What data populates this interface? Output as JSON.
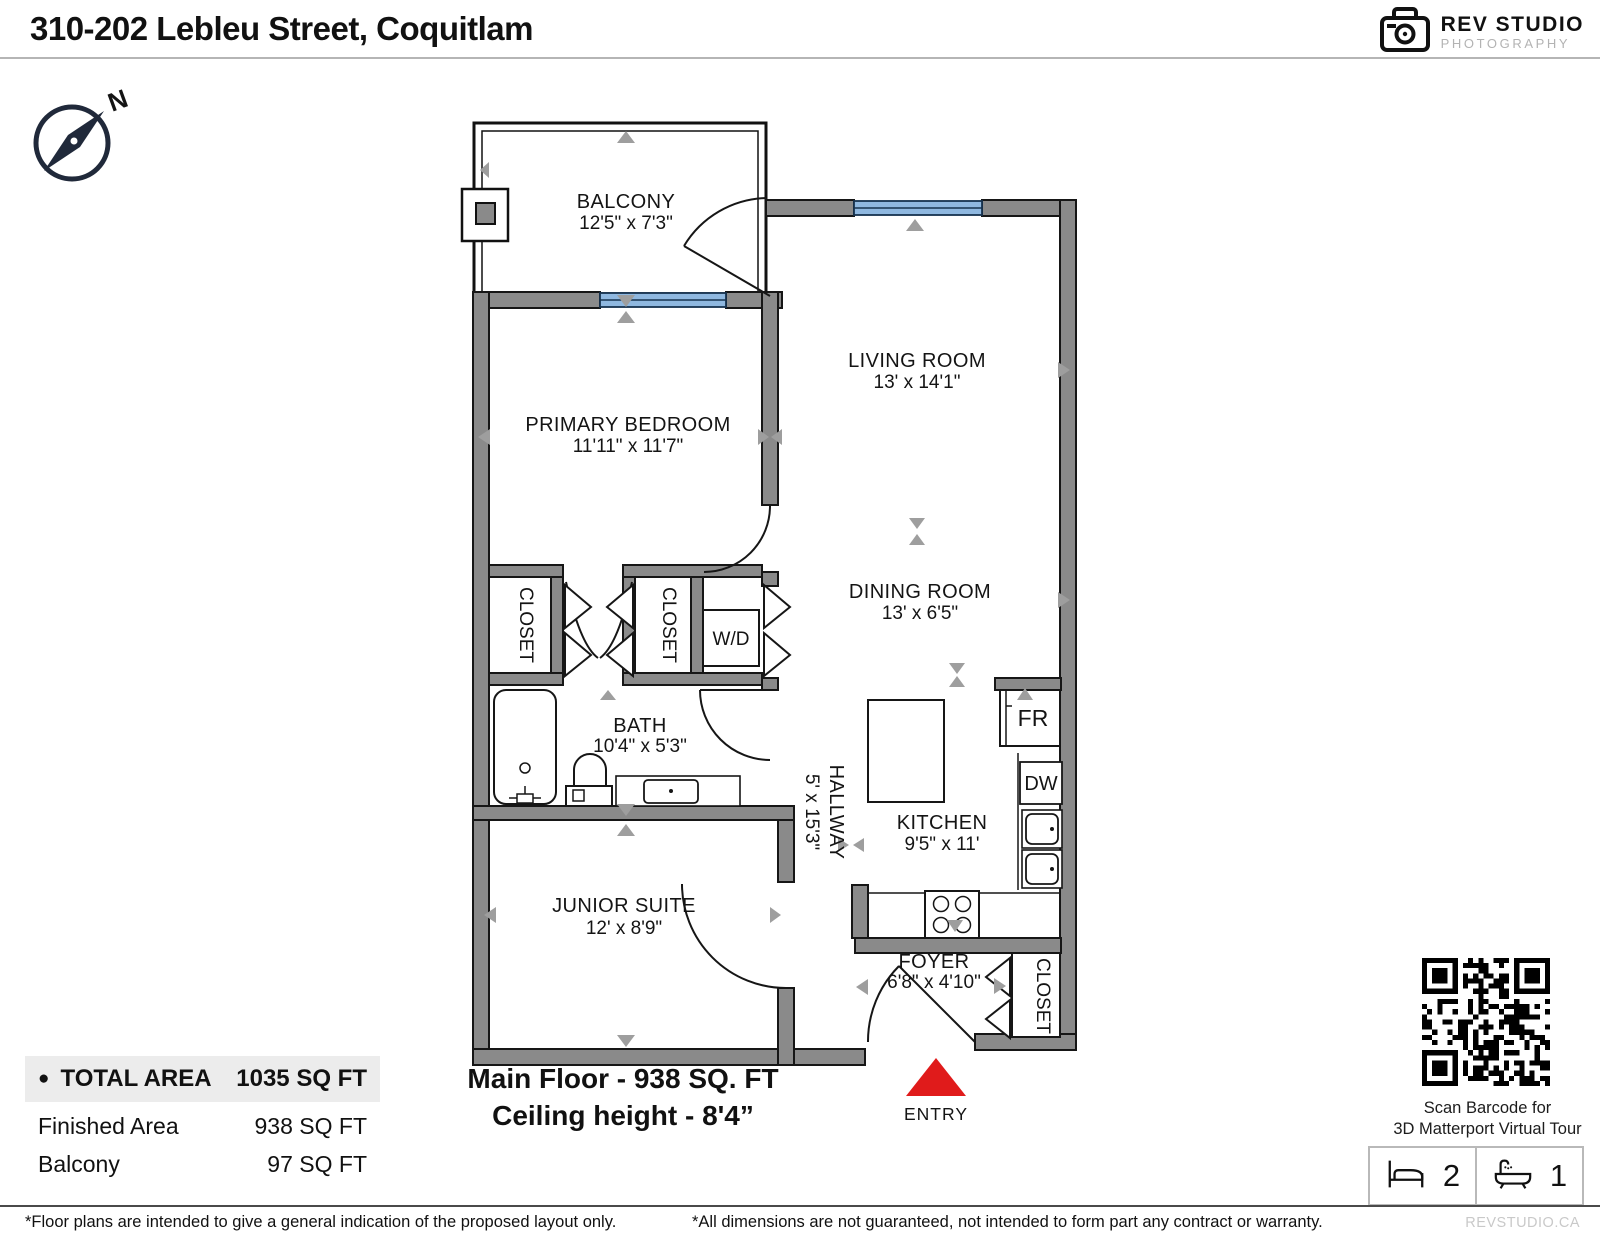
{
  "header": {
    "title": "310-202 Lebleu Street, Coquitlam",
    "logo_line1": "REV STUDIO",
    "logo_line2": "PHOTOGRAPHY"
  },
  "compass": {
    "label": "N"
  },
  "floorplan": {
    "rooms": [
      {
        "name": "BALCONY",
        "dims": "12'5\" x 7'3\""
      },
      {
        "name": "LIVING ROOM",
        "dims": "13' x 14'1\""
      },
      {
        "name": "PRIMARY BEDROOM",
        "dims": "11'11\" x 11'7\""
      },
      {
        "name": "DINING ROOM",
        "dims": "13' x 6'5\""
      },
      {
        "name": "BATH",
        "dims": "10'4\" x 5'3\""
      },
      {
        "name": "HALLWAY",
        "dims": "5' x 15'3\""
      },
      {
        "name": "KITCHEN",
        "dims": "9'5\" x 11'"
      },
      {
        "name": "JUNIOR SUITE",
        "dims": "12' x 8'9\""
      },
      {
        "name": "FOYER",
        "dims": "6'8\" x 4'10\""
      }
    ],
    "labels": {
      "closet": "CLOSET",
      "washer_dryer": "W/D",
      "fridge": "FR",
      "dishwasher": "DW",
      "entry": "ENTRY"
    }
  },
  "areas": {
    "bullet": "●",
    "total_label": "TOTAL AREA",
    "total_value": "1035 SQ FT",
    "finished_label": "Finished Area",
    "finished_value": "938 SQ FT",
    "balcony_label": "Balcony",
    "balcony_value": "97 SQ FT"
  },
  "floor_info": {
    "line1": "Main Floor - 938 SQ. FT",
    "line2": "Ceiling height - 8'4”"
  },
  "qr": {
    "caption_line1": "Scan Barcode for",
    "caption_line2": "3D Matterport Virtual Tour"
  },
  "stats": {
    "beds": "2",
    "baths": "1"
  },
  "footer": {
    "left": "*Floor plans are intended to give a general indication of the proposed layout only.",
    "center": "*All dimensions are not guaranteed, not intended to form part any contract or warranty.",
    "right": "REVSTUDIO.CA"
  }
}
